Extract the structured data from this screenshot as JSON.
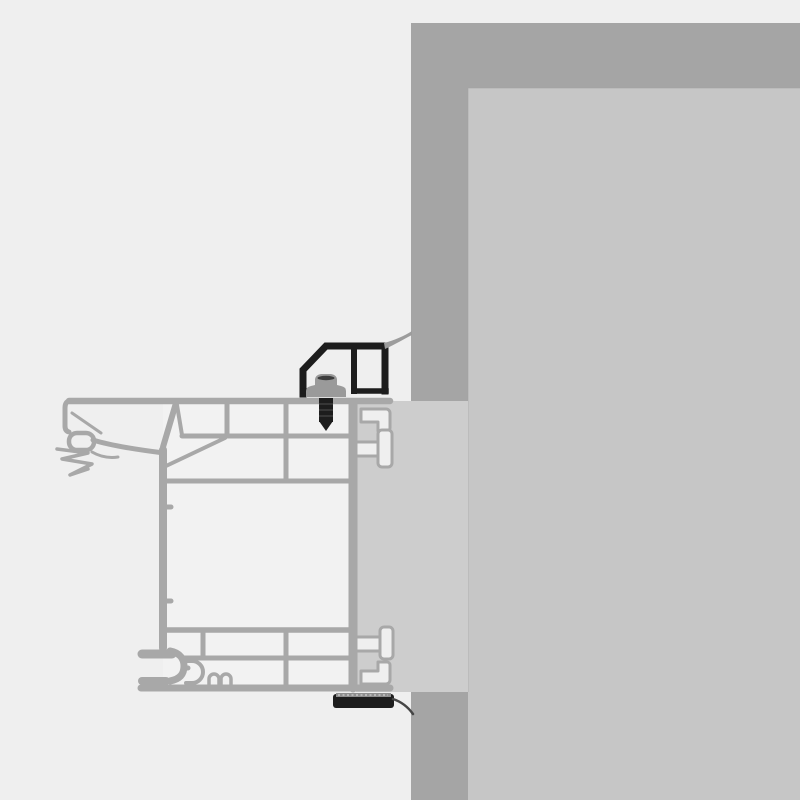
{
  "canvas": {
    "width": 800,
    "height": 800
  },
  "figure": {
    "kind": "technical-cross-section",
    "subject": "window-frame-to-wall-installation-detail",
    "text_labels": []
  },
  "colors": {
    "background": "#efefef",
    "wall": "#a5a5a5",
    "wall_fill": "#c6c6c6",
    "reveal": "#cdcdcd",
    "profile": "#a8a8a8",
    "chamber": "#f2f2f2",
    "cutout": "#efefef",
    "hardware": "#1d1d1d",
    "screw_head": "#9a9a9a",
    "screw_slot": "#3d3d3d",
    "membrane": "#9c9c9c",
    "tape_layer": "#8f8f8f",
    "tape_dash": "#d0d0d0",
    "tail": "#454545",
    "hairline": "#a0a0a0"
  },
  "components": [
    {
      "name": "masonry-wall-outer-band",
      "color_key": "wall"
    },
    {
      "name": "masonry-wall-inner-fill",
      "color_key": "wall_fill"
    },
    {
      "name": "installation-reveal",
      "color_key": "reveal"
    },
    {
      "name": "window-frame-profile",
      "color_key": "profile"
    },
    {
      "name": "glazing-gasket-seal",
      "color_key": "profile"
    },
    {
      "name": "anchor-hook-top",
      "color_key": "cutout"
    },
    {
      "name": "t-connector-top",
      "color_key": "cutout"
    },
    {
      "name": "t-connector-bottom",
      "color_key": "cutout"
    },
    {
      "name": "anchor-hook-bottom",
      "color_key": "cutout"
    },
    {
      "name": "mounting-bracket",
      "color_key": "hardware"
    },
    {
      "name": "fixing-screw",
      "color_key": "screw_head"
    },
    {
      "name": "sealing-membrane-top",
      "color_key": "membrane"
    },
    {
      "name": "sealing-tape-bottom",
      "color_key": "hardware"
    },
    {
      "name": "membrane-tail-bottom",
      "color_key": "tail"
    }
  ]
}
